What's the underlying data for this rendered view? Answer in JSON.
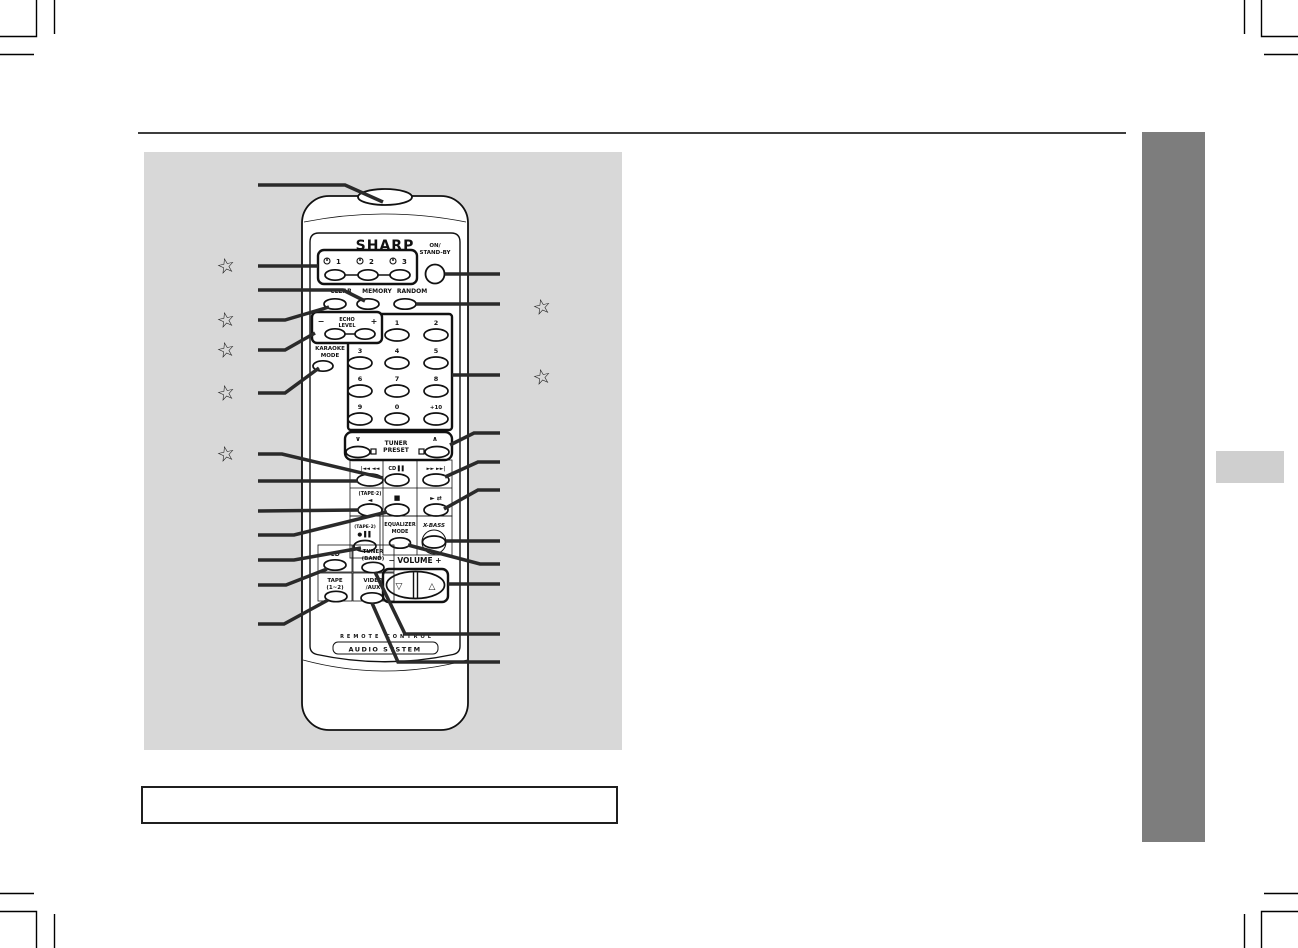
{
  "page": {
    "panel_bg": "#d8d8d8",
    "rule_color": "#3d3d3d",
    "sidebar_color": "#7d7d7d",
    "edge_tab_color": "#cfcfcf",
    "callout_color": "#2a2a2a",
    "star": "☆"
  },
  "remote": {
    "brand": "SHARP",
    "power": {
      "line1": "ON/",
      "line2": "STAND-BY"
    },
    "timers": [
      "1",
      "2",
      "3"
    ],
    "clear": "CLEAR",
    "memory": "MEMORY",
    "random": "RANDOM",
    "echo": {
      "minus": "−",
      "line1": "ECHO",
      "line2": "LEVEL",
      "plus": "+"
    },
    "karaoke": {
      "line1": "KARAOKE",
      "line2": "MODE"
    },
    "numpad": [
      "1",
      "2",
      "3",
      "4",
      "5",
      "6",
      "7",
      "8",
      "9",
      "0",
      "+10"
    ],
    "tuner_preset": {
      "down": "∨",
      "up": "∧",
      "line1": "TUNER",
      "line2": "PRESET"
    },
    "transport": {
      "skip_down": "|◄◄ ◄◄",
      "cd_pause": "CD ▌▌",
      "skip_up": "►► ►►|",
      "tape2": "(TAPE·2)",
      "reverse": "◄",
      "stop": "■",
      "forward": "► ⇄",
      "rec_label": "(TAPE·2)",
      "rec": "● ▌▌"
    },
    "equalizer": {
      "line1": "EQUALIZER",
      "line2": "MODE"
    },
    "xbass": "X-BASS",
    "volume": {
      "label": "− VOLUME +",
      "down": "▽",
      "up": "△"
    },
    "sources": {
      "cd": "CD",
      "tuner1": "TUNER",
      "tuner2": "(BAND)",
      "tape1": "TAPE",
      "tape2": "(1~2)",
      "video1": "VIDEO",
      "video2": "/AUX"
    },
    "footer": {
      "line1": "REMOTE CONTROL",
      "line2": "AUDIO SYSTEM"
    }
  }
}
